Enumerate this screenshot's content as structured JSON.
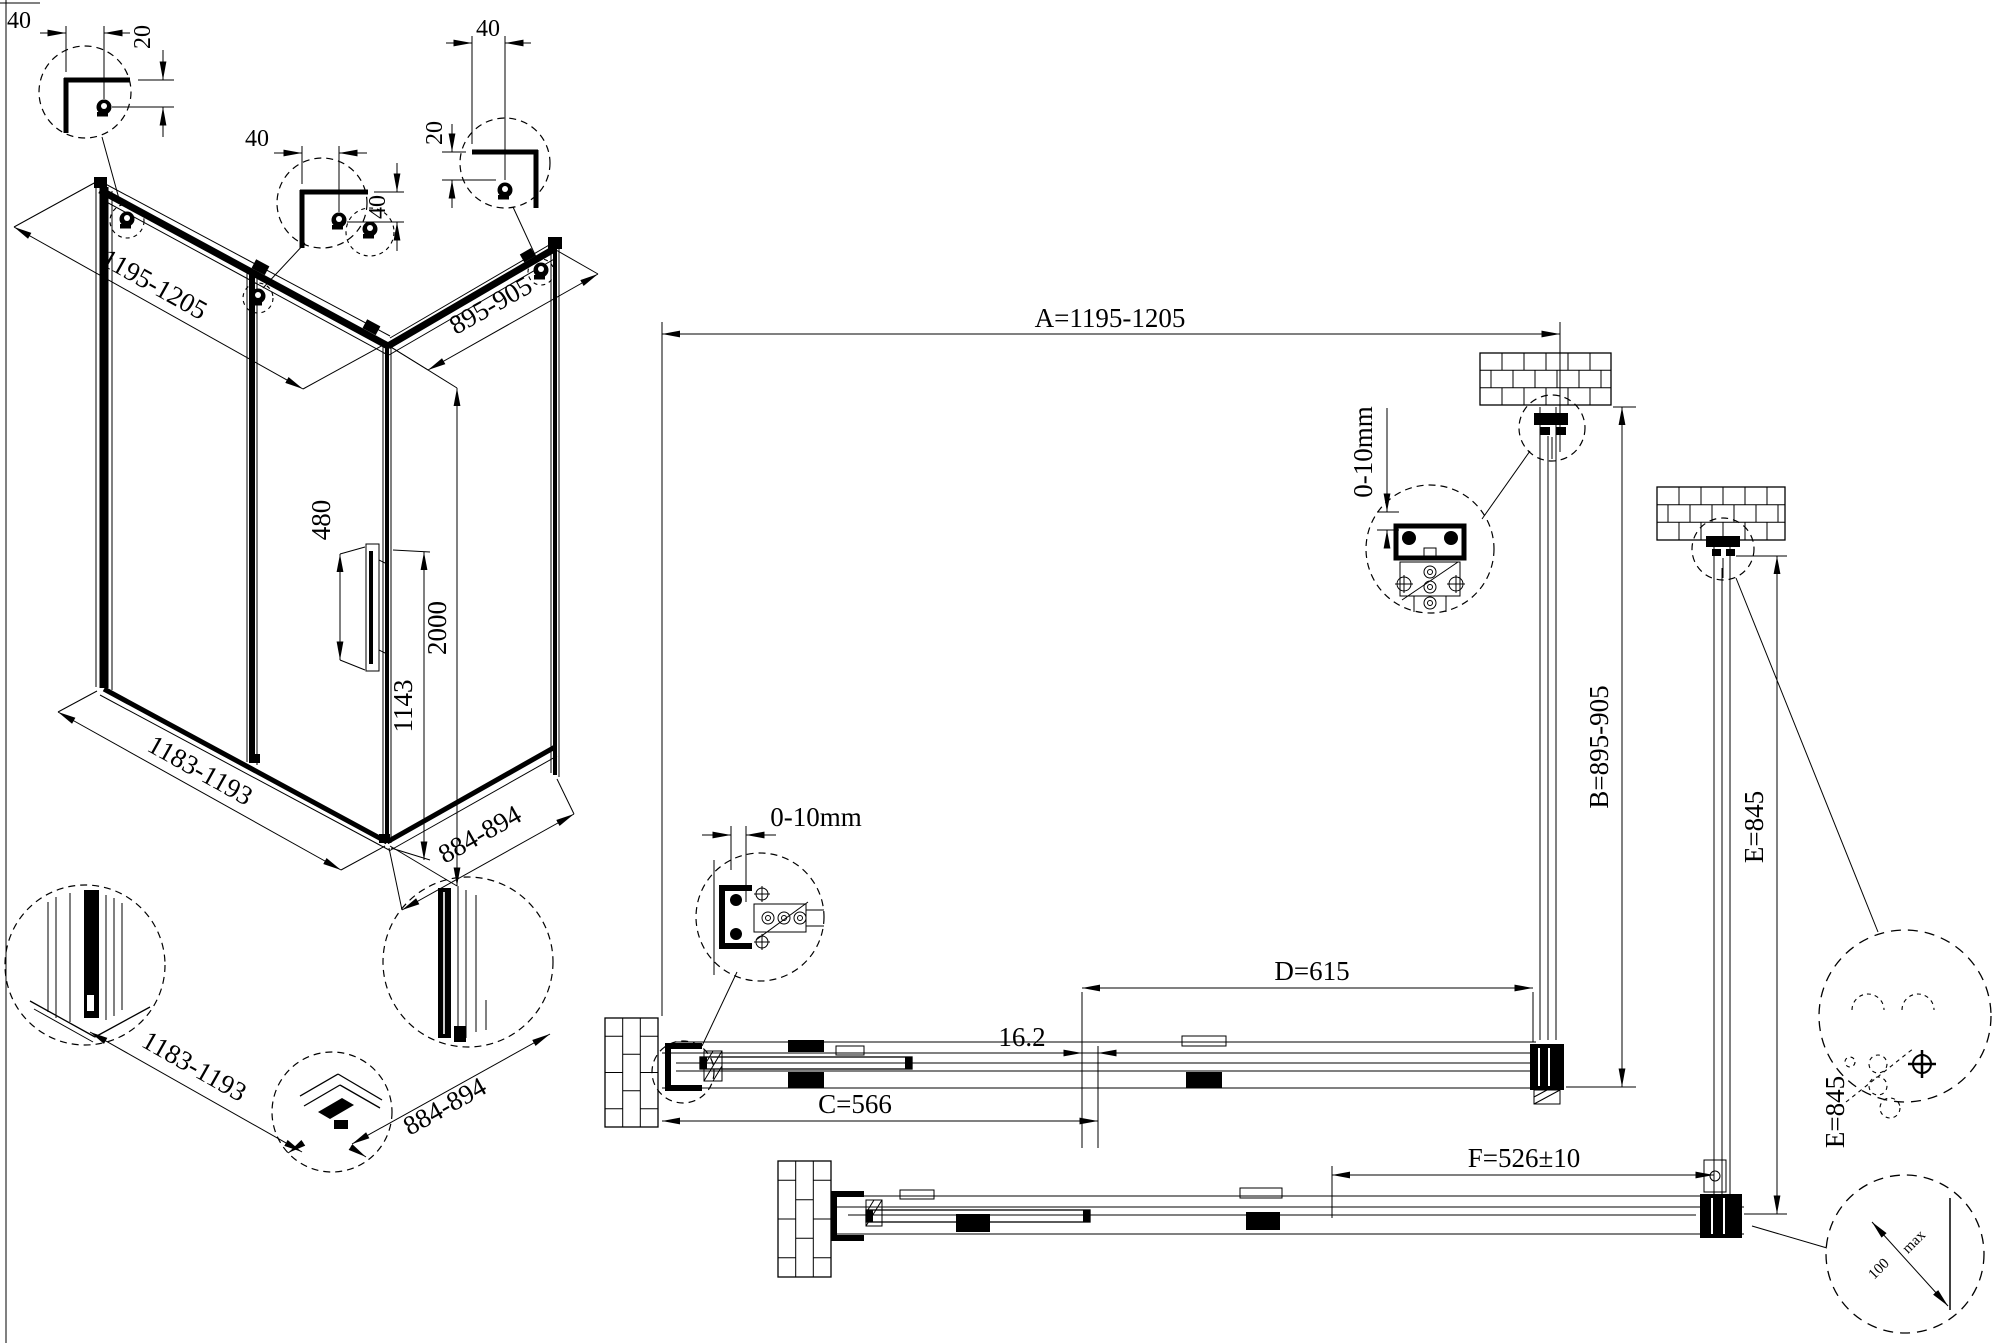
{
  "meta": {
    "background": "#ffffff",
    "line_color": "#000000",
    "drawing_type": "shower enclosure technical drawing"
  },
  "iso": {
    "detail_a": {
      "width": "40",
      "height": "20"
    },
    "detail_b": {
      "width": "40",
      "height": "40"
    },
    "detail_c": {
      "height": "20",
      "width": "40"
    },
    "top_width": "1195-1205",
    "top_depth": "895-905",
    "handle_length": "480",
    "total_height": "2000",
    "lower_height": "1143",
    "bottom_width": "1183-1193",
    "bottom_depth": "884-894"
  },
  "details_bottom": {
    "front_width": "1183-1193",
    "side_depth": "884-894"
  },
  "plan": {
    "width_a": "A=1195-1205",
    "depth_b": "B=895-905",
    "fixed_c": "C=566",
    "door_d": "D=615",
    "side_e": "E=845",
    "side_e_right": "E=845",
    "door_f": "F=526±10",
    "overlap": "16.2",
    "wall_gap_top": "0-10mm",
    "wall_gap_left": "0-10mm",
    "corner_dim": "100",
    "corner_dim_unit": "max"
  }
}
